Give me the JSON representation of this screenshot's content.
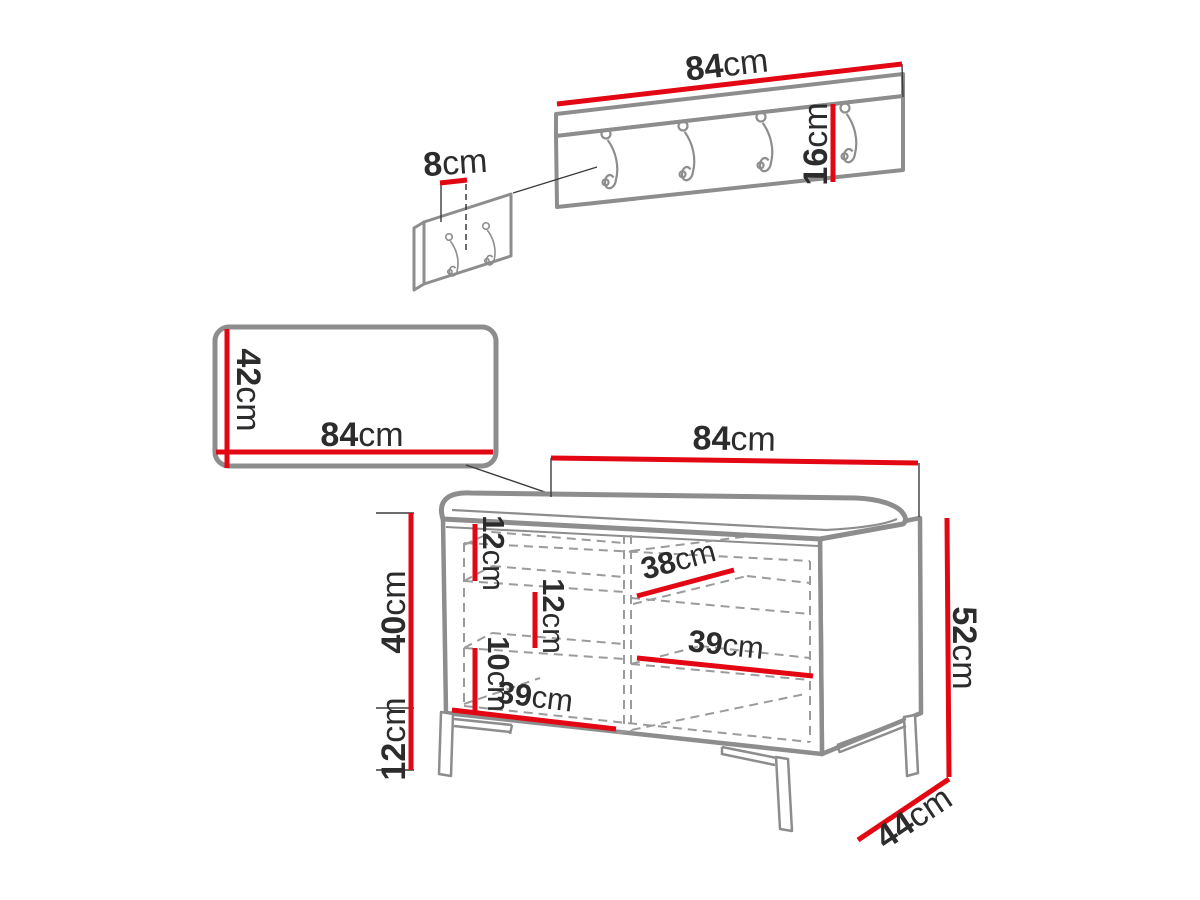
{
  "colors": {
    "dimension_red": "#e30613",
    "outline_gray": "#8d8d8d",
    "dashed_gray": "#9b9b9b",
    "text_dark": "#2c2c2c",
    "background": "#ffffff"
  },
  "rack": {
    "width": {
      "value": "84",
      "unit": "cm"
    },
    "height": {
      "value": "16",
      "unit": "cm"
    }
  },
  "hook_panel": {
    "hook_spacing": {
      "value": "8",
      "unit": "cm"
    }
  },
  "mirror": {
    "width": {
      "value": "84",
      "unit": "cm"
    },
    "height": {
      "value": "42",
      "unit": "cm"
    }
  },
  "bench": {
    "width": {
      "value": "84",
      "unit": "cm"
    },
    "height": {
      "value": "52",
      "unit": "cm"
    },
    "depth": {
      "value": "44",
      "unit": "cm"
    },
    "body_height": {
      "value": "40",
      "unit": "cm"
    },
    "leg_height": {
      "value": "12",
      "unit": "cm"
    },
    "compartment_top": {
      "value": "12",
      "unit": "cm"
    },
    "compartment_middle": {
      "value": "12",
      "unit": "cm"
    },
    "compartment_bottom": {
      "value": "10",
      "unit": "cm"
    },
    "shelf_top": {
      "value": "38",
      "unit": "cm"
    },
    "shelf_middle": {
      "value": "39",
      "unit": "cm"
    },
    "shelf_bottom": {
      "value": "39",
      "unit": "cm"
    }
  }
}
